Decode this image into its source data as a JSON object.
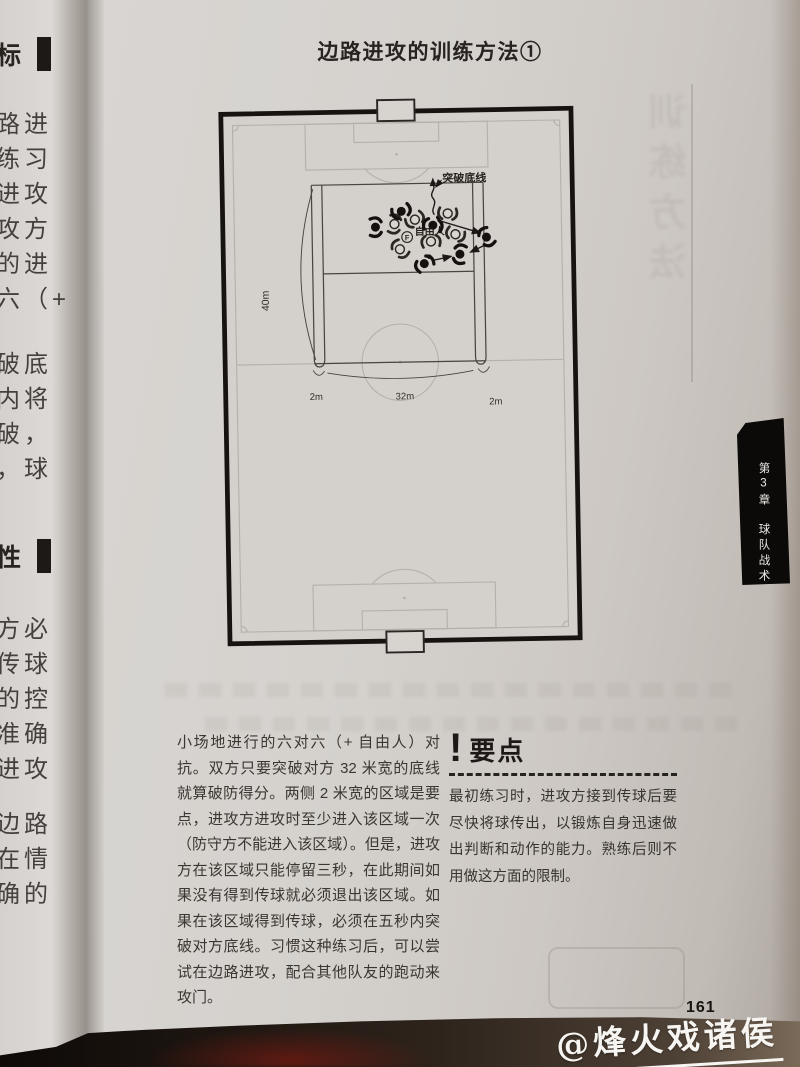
{
  "page": {
    "title": "边路进攻的训练方法①",
    "page_number": "161",
    "watermark": "@烽火戏诸侯"
  },
  "chapter_tab": {
    "chapter": "第3章",
    "section": "球队战术"
  },
  "description": "小场地进行的六对六（+ 自由人）对抗。双方只要突破对方 32 米宽的底线就算破防得分。两侧 2 米宽的区域是要点，进攻方进攻时至少进入该区域一次（防守方不能进入该区域）。但是，进攻方在该区域只能停留三秒，在此期间如果没有得到传球就必须退出该区域。如果在该区域得到传球，必须在五秒内突破对方底线。习惯这种练习后，可以尝试在边路进攻，配合其他队友的跑动来攻门。",
  "key_points": {
    "mark": "!",
    "heading": "要点",
    "body": "最初练习时，进攻方接到传球后要尽快将球传出，以锻炼自身迅速做出判断和动作的能力。熟练后则不用做这方面的限制。"
  },
  "diagram": {
    "labels": {
      "breakthrough": "突破底线",
      "free_player": "自由人",
      "free_player_mark": "F",
      "depth": "40m",
      "left_width": "2m",
      "center_width": "32m",
      "right_width": "2m"
    },
    "players": [
      {
        "t": "w",
        "x": 236,
        "y": 107,
        "r": 185
      },
      {
        "t": "w",
        "x": 179,
        "y": 118,
        "r": 100
      },
      {
        "t": "w",
        "x": 201,
        "y": 113,
        "r": 150
      },
      {
        "t": "w",
        "x": 218,
        "y": 138,
        "r": 355
      },
      {
        "t": "w",
        "x": 186,
        "y": 144,
        "r": 230
      },
      {
        "t": "w",
        "x": 244,
        "y": 129,
        "r": 200
      },
      {
        "t": "b",
        "x": 187,
        "y": 104,
        "r": 160
      },
      {
        "t": "b",
        "x": 220,
        "y": 121,
        "r": 10
      },
      {
        "t": "b",
        "x": 159,
        "y": 121,
        "r": 90
      },
      {
        "t": "b",
        "x": 211,
        "y": 161,
        "r": 330
      },
      {
        "t": "b",
        "x": 249,
        "y": 151,
        "r": 280
      },
      {
        "t": "b",
        "x": 277,
        "y": 133,
        "r": 240
      }
    ],
    "balls": [
      {
        "x": 226,
        "y": 112
      },
      {
        "x": 216,
        "y": 153
      }
    ],
    "arrows": [
      {
        "x1": 229,
        "y1": 116,
        "x2": 270,
        "y2": 129
      },
      {
        "x1": 274,
        "y1": 142,
        "x2": 259,
        "y2": 149
      },
      {
        "x1": 219,
        "y1": 157,
        "x2": 239,
        "y2": 153
      }
    ]
  },
  "left_page_fragments": [
    {
      "y": 36,
      "text": "标",
      "header": true
    },
    {
      "y": 104,
      "text": "路进"
    },
    {
      "y": 139,
      "text": "练习"
    },
    {
      "y": 174,
      "text": "进攻"
    },
    {
      "y": 209,
      "text": "攻方"
    },
    {
      "y": 244,
      "text": "的进"
    },
    {
      "y": 279,
      "text": "六（+"
    },
    {
      "y": 344,
      "text": "破底"
    },
    {
      "y": 379,
      "text": "内将"
    },
    {
      "y": 414,
      "text": "破，"
    },
    {
      "y": 449,
      "text": "，球"
    },
    {
      "y": 538,
      "text": "性",
      "header": true
    },
    {
      "y": 609,
      "text": "方必"
    },
    {
      "y": 644,
      "text": "传球"
    },
    {
      "y": 679,
      "text": "的控"
    },
    {
      "y": 714,
      "text": "准确"
    },
    {
      "y": 749,
      "text": "进攻"
    },
    {
      "y": 804,
      "text": "边路"
    },
    {
      "y": 839,
      "text": "在情"
    },
    {
      "y": 874,
      "text": "确的"
    }
  ],
  "ghost": {
    "vertical_text": "训练方法"
  }
}
